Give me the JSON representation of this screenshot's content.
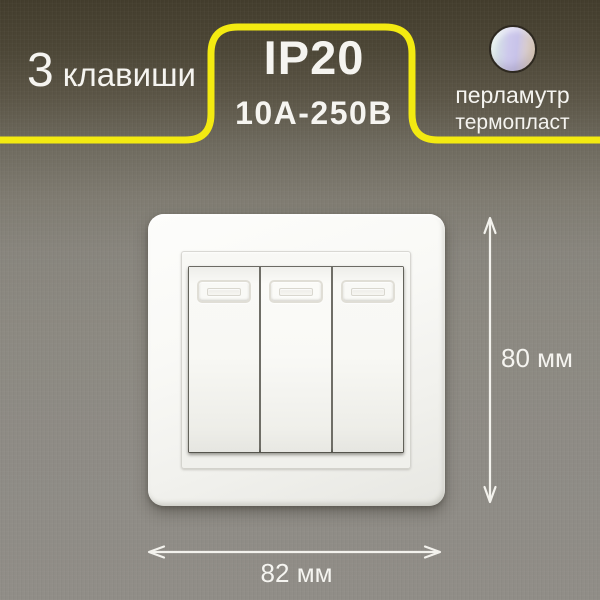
{
  "labels": {
    "keys_count": "3",
    "keys_word": "клавиши",
    "protection_rating": "IP20",
    "electrical_rating": "10А-250В",
    "material_color": "перламутр",
    "material_type": "термопласт",
    "dimension_height": "80 мм",
    "dimension_width": "82 мм"
  },
  "colors": {
    "accent_yellow": "#f3ea11",
    "text": "#f5f4f0",
    "background_top": "#433d2d",
    "background_bottom": "#908d87",
    "plate_white": "#f6f6f2",
    "pearl_swatch_left": "#daf0e3",
    "pearl_swatch_middle": "#cdc9ec",
    "pearl_swatch_right": "#f1ddb4"
  },
  "switch": {
    "keys": 3,
    "plate_color": "white"
  }
}
